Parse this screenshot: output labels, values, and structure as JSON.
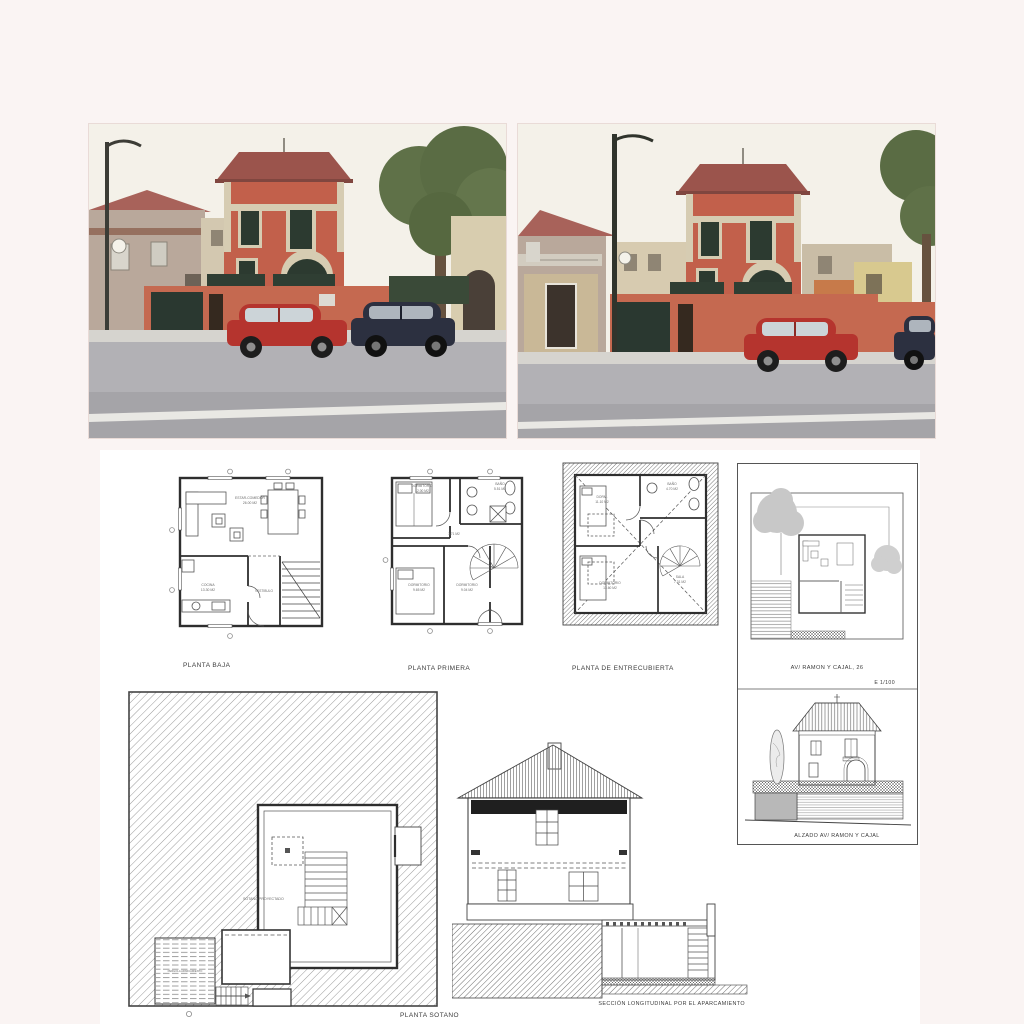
{
  "drawings": {
    "planta_baja": {
      "caption": "PLANTA BAJA",
      "estar": "ESTAR-COMEDOR",
      "estar_area": "26.00 M2",
      "cocina": "COCINA",
      "cocina_area": "13.30 M2",
      "vestibulo": "VESTIBULO"
    },
    "planta_primera": {
      "caption": "PLANTA PRIMERA",
      "dorm1": "DORMITORIO",
      "dorm1_area": "12.00 M2",
      "bano": "BAÑO",
      "bano_area": "5.51 M2",
      "hall_area": "3.71 M2",
      "dorm2": "DORMITORIO",
      "dorm2_area": "9.65 M2",
      "dorm3": "DORMITORIO",
      "dorm3_area": "9.04 M2"
    },
    "planta_entrecubierta": {
      "caption": "PLANTA DE ENTRECUBIERTA",
      "dorm1": "DORM.",
      "dorm1_area": "11.10 M2",
      "bano": "BAÑO",
      "bano_area": "4.70 M2",
      "dorm2": "DORMITORIO",
      "dorm2_area": "13.60 M2",
      "sala": "SALA",
      "sala_area": "7.31 M2"
    },
    "site_plan": {
      "caption": "AV/ RAMON Y CAJAL, 26",
      "scale": "E 1/100"
    },
    "elevation": {
      "caption": "ALZADO AV/ RAMON Y CAJAL"
    },
    "planta_sotano": {
      "caption": "PLANTA SOTANO",
      "sotano_label": "SOTANO PROYECTADO",
      "pergola_label": "PERGOLA APARCAMIENTO"
    },
    "section": {
      "caption": "SECCIÓN LONGITUDINAL POR EL APARCAMIENTO"
    }
  },
  "colors": {
    "page_bg": "#faf4f3",
    "sheet_bg": "#ffffff",
    "house_wall": "#c2604b",
    "roof": "#9b544c",
    "trim": "#d6ccb2",
    "shutter": "#2c3a30",
    "road": "#b2b1b5",
    "red_car": "#b5342e",
    "dark_car": "#2c3040",
    "tree": "#5f7148",
    "ink": "#3a3a3a"
  }
}
